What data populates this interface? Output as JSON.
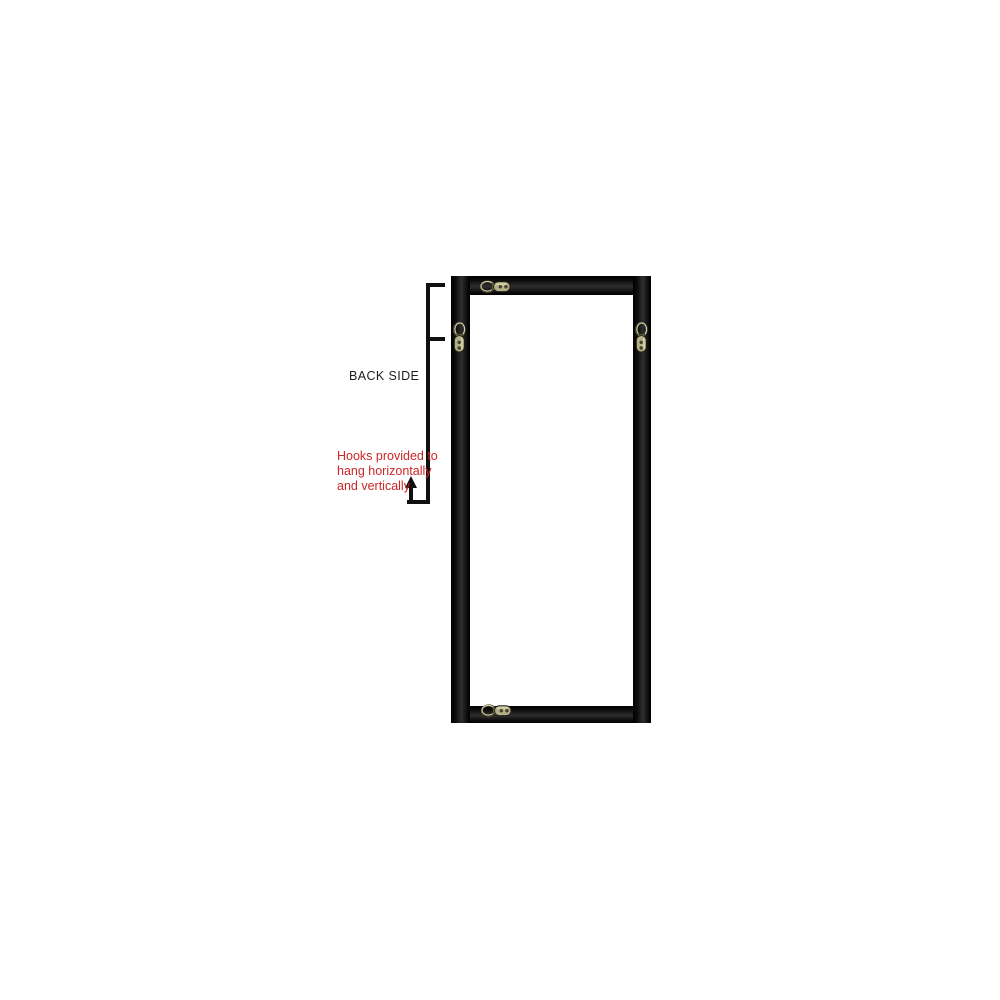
{
  "page": {
    "background": "#ffffff"
  },
  "labels": {
    "back_side": "BACK SIDE"
  },
  "annotation": {
    "line1": "Hooks provided to",
    "line2": "hang horizontally",
    "line3": "and vertically",
    "text_color": "#cc2626"
  },
  "frame": {
    "description": "back side of tall black rectangular frame",
    "rail_edge_color": "#000000",
    "rail_sheen_color": "#2e2e2e"
  },
  "hooks": {
    "plate_color": "#b3b189",
    "ring_light_color": "#d6d4ab",
    "ring_dark_color": "#3f3d2b",
    "screw_color": "#45432f",
    "items": [
      {
        "id": "hook-top",
        "orientation": "horizontal",
        "position": "top-center"
      },
      {
        "id": "hook-left",
        "orientation": "vertical",
        "position": "left-upper"
      },
      {
        "id": "hook-right",
        "orientation": "vertical",
        "position": "right-upper"
      },
      {
        "id": "hook-bottom",
        "orientation": "horizontal",
        "position": "bottom-center"
      }
    ]
  }
}
